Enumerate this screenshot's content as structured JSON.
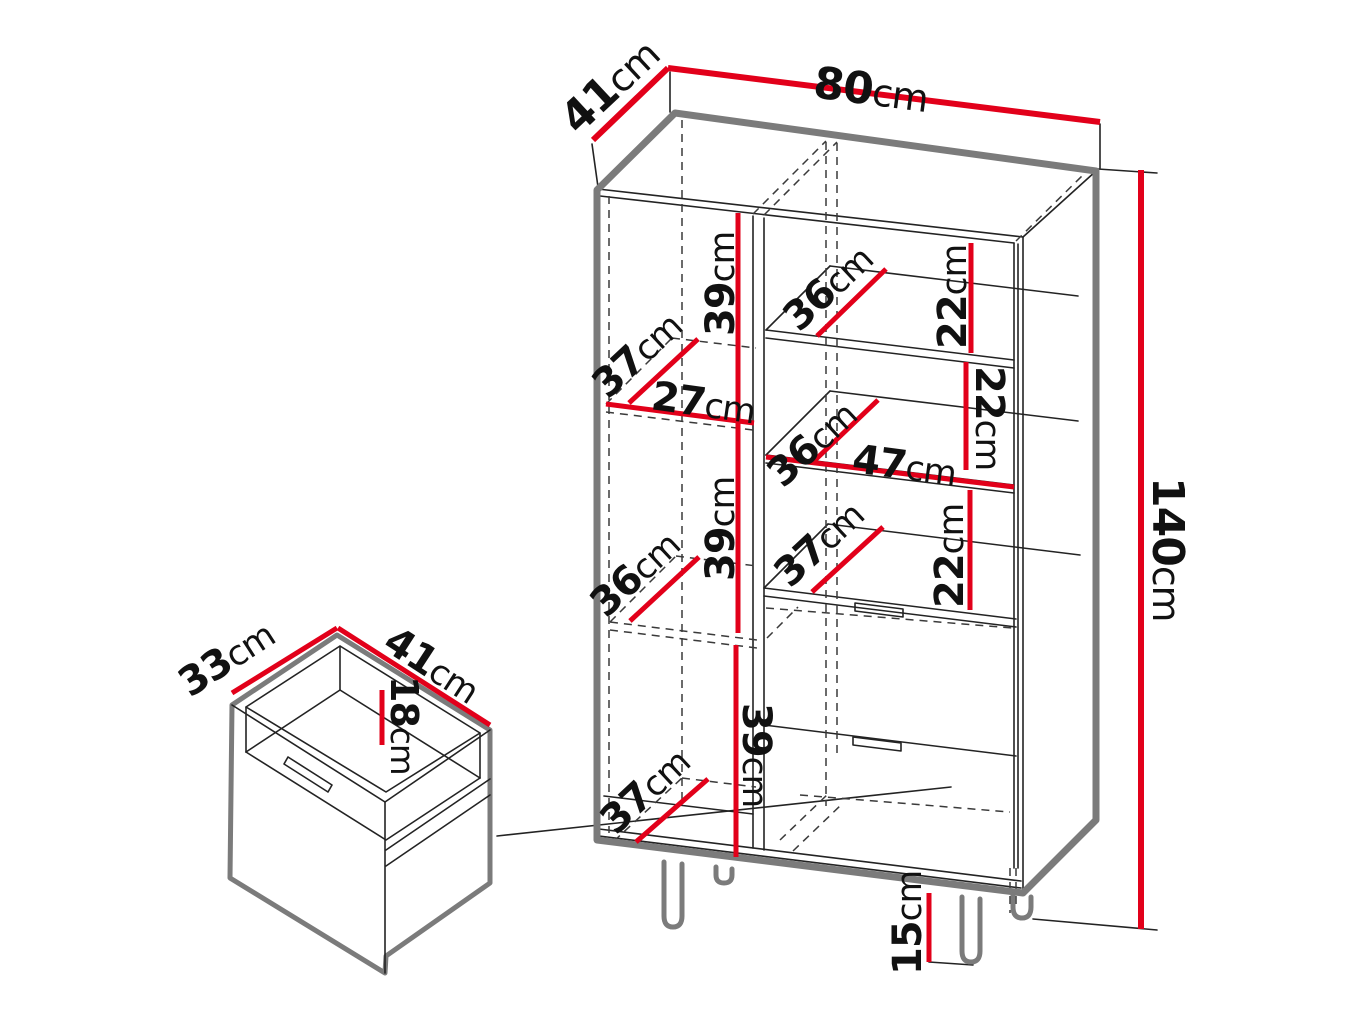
{
  "page": {
    "background": "#ffffff"
  },
  "colors": {
    "dimension_red": "#e2001a",
    "outline_gray": "#7b7b7b",
    "line_dark": "#232323",
    "text_black": "#111111"
  },
  "cabinet": {
    "overall": {
      "width": {
        "value": "80",
        "unit": "cm"
      },
      "depth": {
        "value": "41",
        "unit": "cm"
      },
      "height": {
        "value": "140",
        "unit": "cm"
      },
      "leg_height": {
        "value": "15",
        "unit": "cm"
      }
    },
    "left_section": {
      "top_shelf_depth": {
        "value": "37",
        "unit": "cm"
      },
      "interior_width": {
        "value": "27",
        "unit": "cm"
      },
      "top_compartment_height": {
        "value": "39",
        "unit": "cm"
      },
      "middle_shelf_depth": {
        "value": "36",
        "unit": "cm"
      },
      "middle_compartment_height": {
        "value": "39",
        "unit": "cm"
      },
      "bottom_panel_depth": {
        "value": "37",
        "unit": "cm"
      },
      "bottom_compartment_height": {
        "value": "39",
        "unit": "cm"
      }
    },
    "right_section": {
      "shelf1_depth": {
        "value": "36",
        "unit": "cm"
      },
      "gap1_height": {
        "value": "22",
        "unit": "cm"
      },
      "shelf2_depth": {
        "value": "36",
        "unit": "cm"
      },
      "interior_width": {
        "value": "47",
        "unit": "cm"
      },
      "gap2_height": {
        "value": "22",
        "unit": "cm"
      },
      "shelf3_depth": {
        "value": "37",
        "unit": "cm"
      },
      "gap3_height": {
        "value": "22",
        "unit": "cm"
      }
    }
  },
  "drawer_detail": {
    "depth": {
      "value": "33",
      "unit": "cm"
    },
    "width": {
      "value": "41",
      "unit": "cm"
    },
    "height": {
      "value": "18",
      "unit": "cm"
    }
  }
}
